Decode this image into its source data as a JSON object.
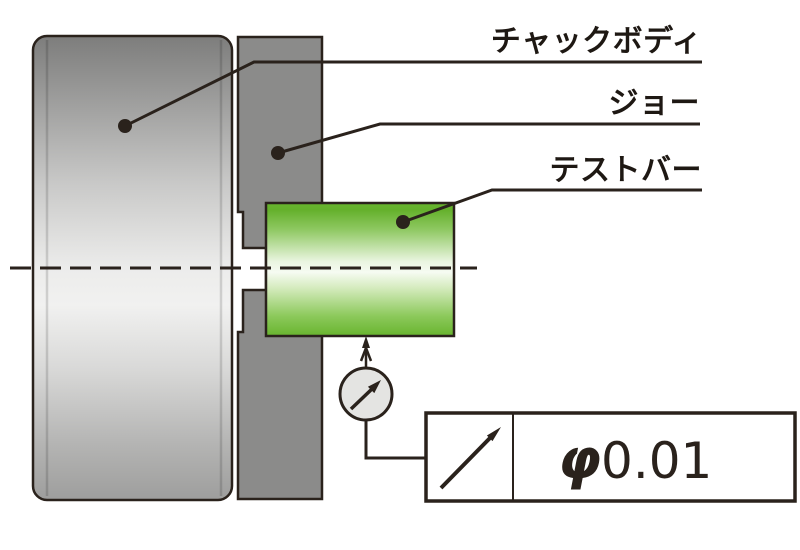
{
  "labels": {
    "chuck_body": "チャックボディ",
    "jaw": "ジョー",
    "test_bar": "テストバー"
  },
  "tolerance": {
    "phi": "φ",
    "value": "0.01",
    "symbol_icon": "runout-diagonal-up-right-arrow"
  },
  "icons": {
    "dial_indicator": "circle-gauge-with-needle-arrow",
    "stylus": "up-arrow-contact-tip"
  },
  "colors": {
    "line_dark": "#2a221c",
    "label_color": "#1e1813",
    "chuck_gray": "#8b8b8a",
    "jaw_gray": "#8b8b8a",
    "bar_green": "#68b52e",
    "dial_fill": "#e4e4e2",
    "frame_bg": "#ffffff"
  }
}
